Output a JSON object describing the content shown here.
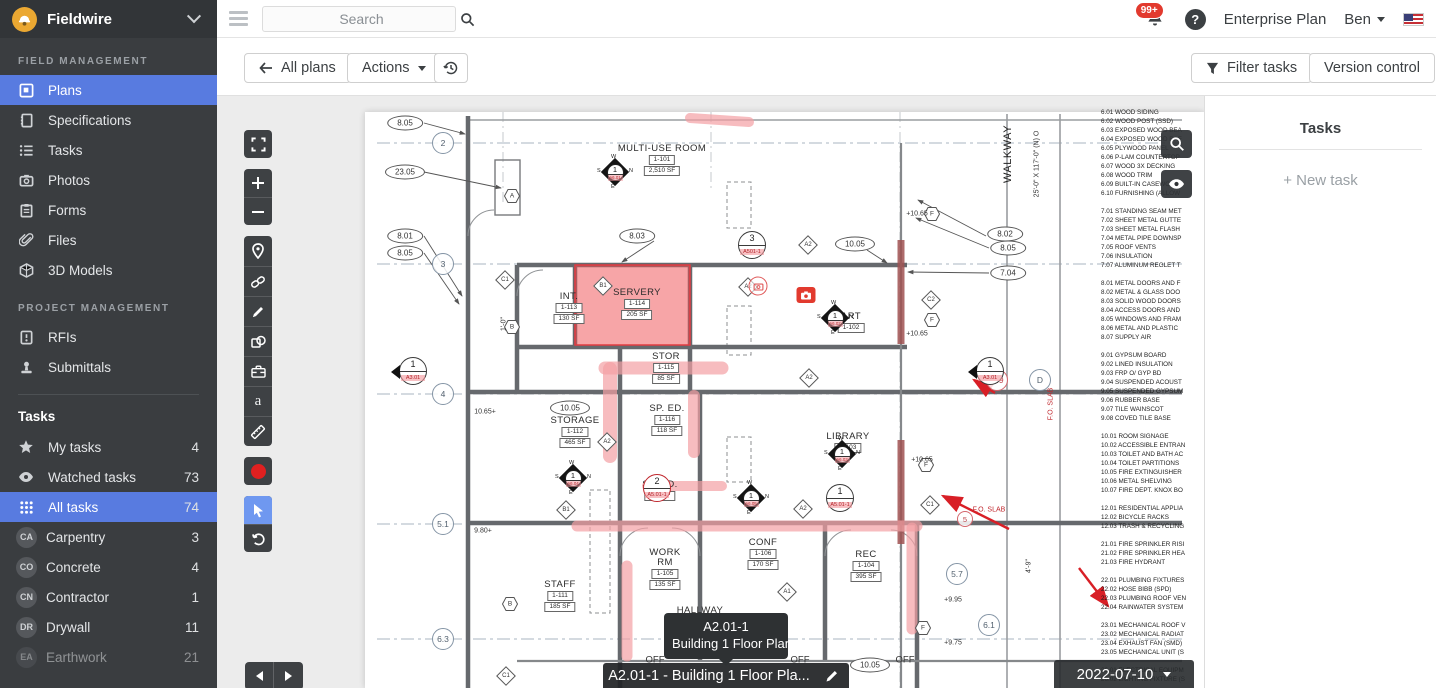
{
  "brand": {
    "name": "Fieldwire"
  },
  "topbar": {
    "search_placeholder": "Search",
    "notif_badge": "99+",
    "help_label": "?",
    "plan_label": "Enterprise Plan",
    "user_name": "Ben"
  },
  "toolbar": {
    "all_plans": "All plans",
    "actions": "Actions",
    "filter_tasks": "Filter tasks",
    "version_control": "Version control"
  },
  "sidebar": {
    "field_mgmt_label": "FIELD MANAGEMENT",
    "project_mgmt_label": "PROJECT MANAGEMENT",
    "tasks_label": "Tasks",
    "field_items": [
      {
        "label": "Plans",
        "icon": "plans-icon",
        "active": true
      },
      {
        "label": "Specifications",
        "icon": "specifications-icon"
      },
      {
        "label": "Tasks",
        "icon": "tasks-icon"
      },
      {
        "label": "Photos",
        "icon": "photos-icon"
      },
      {
        "label": "Forms",
        "icon": "forms-icon"
      },
      {
        "label": "Files",
        "icon": "files-icon"
      },
      {
        "label": "3D Models",
        "icon": "3d-models-icon"
      }
    ],
    "project_items": [
      {
        "label": "RFIs",
        "icon": "rfis-icon"
      },
      {
        "label": "Submittals",
        "icon": "submittals-icon"
      }
    ],
    "task_items": [
      {
        "label": "My tasks",
        "count": "4",
        "icon": "star-icon"
      },
      {
        "label": "Watched tasks",
        "count": "73",
        "icon": "eye-icon"
      },
      {
        "label": "All tasks",
        "count": "74",
        "icon": "grid-icon",
        "active": true
      },
      {
        "label": "Carpentry",
        "count": "3",
        "badge": "CA"
      },
      {
        "label": "Concrete",
        "count": "4",
        "badge": "CO"
      },
      {
        "label": "Contractor",
        "count": "1",
        "badge": "CN"
      },
      {
        "label": "Drywall",
        "count": "11",
        "badge": "DR"
      },
      {
        "label": "Earthwork",
        "count": "21",
        "badge": "EA"
      }
    ]
  },
  "tasks_panel": {
    "title": "Tasks",
    "new_task": "+ New task"
  },
  "plan": {
    "title_bar": "A2.01-1 - Building 1 Floor Pla...",
    "tooltip_line1": "A2.01-1",
    "tooltip_line2": "Building 1 Floor Plan",
    "version_date": "2022-07-10",
    "rooms": [
      {
        "x": 445,
        "y": 48,
        "name": "MULTI-USE ROOM",
        "num": "1-101",
        "area": "2,510 SF"
      },
      {
        "x": 352,
        "y": 196,
        "name": "INT.",
        "num": "1-113",
        "area": "130 SF"
      },
      {
        "x": 420,
        "y": 192,
        "name": "SERVERY",
        "num": "1-114",
        "area": "205 SF"
      },
      {
        "x": 449,
        "y": 256,
        "name": "STOR",
        "num": "1-115",
        "area": "85 SF"
      },
      {
        "x": 634,
        "y": 216,
        "name": "ART",
        "num": "1-102",
        "area": ""
      },
      {
        "x": 358,
        "y": 320,
        "name": "STORAGE",
        "num": "1-112",
        "area": "465 SF"
      },
      {
        "x": 450,
        "y": 308,
        "name": "SP. ED.",
        "num": "1-116",
        "area": "118 SF"
      },
      {
        "x": 443,
        "y": 384,
        "name": "SP. ED.",
        "num": "",
        "area": "118 SF"
      },
      {
        "x": 631,
        "y": 336,
        "name": "LIBRARY",
        "num": "1-103",
        "area": ""
      },
      {
        "x": 448,
        "y": 452,
        "name": "WORK\nRM",
        "num": "1-105",
        "area": "135 SF"
      },
      {
        "x": 546,
        "y": 442,
        "name": "CONF",
        "num": "1-106",
        "area": "170 SF"
      },
      {
        "x": 649,
        "y": 454,
        "name": "REC",
        "num": "1-104",
        "area": "395 SF"
      },
      {
        "x": 343,
        "y": 484,
        "name": "STAFF",
        "num": "1-111",
        "area": "185 SF"
      },
      {
        "x": 483,
        "y": 510,
        "name": "HALLWAY",
        "num": "",
        "area": ""
      }
    ],
    "ellipse_callouts": [
      {
        "x": 188,
        "y": 27,
        "label": "8.05"
      },
      {
        "x": 188,
        "y": 76,
        "label": "23.05"
      },
      {
        "x": 188,
        "y": 140,
        "label": "8.01"
      },
      {
        "x": 188,
        "y": 157,
        "label": "8.05"
      },
      {
        "x": 420,
        "y": 140,
        "label": "8.03"
      },
      {
        "x": 638,
        "y": 148,
        "label": "10.05"
      },
      {
        "x": 788,
        "y": 138,
        "label": "8.02"
      },
      {
        "x": 791,
        "y": 152,
        "label": "8.05"
      },
      {
        "x": 791,
        "y": 177,
        "label": "7.04"
      },
      {
        "x": 353,
        "y": 312,
        "label": "10.05"
      },
      {
        "x": 653,
        "y": 569,
        "label": "10.05"
      }
    ],
    "grid_circles": [
      {
        "x": 226,
        "y": 47,
        "label": "2"
      },
      {
        "x": 226,
        "y": 168,
        "label": "3"
      },
      {
        "x": 226,
        "y": 298,
        "label": "4"
      },
      {
        "x": 226,
        "y": 428,
        "label": "5.1"
      },
      {
        "x": 226,
        "y": 543,
        "label": "6.3"
      },
      {
        "x": 740,
        "y": 478,
        "label": "5.7"
      },
      {
        "x": 772,
        "y": 529,
        "label": "6.1"
      },
      {
        "x": 780,
        "y": 284,
        "label": "C.9",
        "cls": "red"
      },
      {
        "x": 823,
        "y": 284,
        "label": "D"
      },
      {
        "x": 748,
        "y": 423,
        "label": "5",
        "cls": "red sm"
      }
    ],
    "hex_markers": [
      {
        "x": 295,
        "y": 100,
        "label": "A"
      },
      {
        "x": 295,
        "y": 231,
        "label": "B"
      },
      {
        "x": 293,
        "y": 508,
        "label": "B"
      },
      {
        "x": 715,
        "y": 118,
        "label": "F"
      },
      {
        "x": 715,
        "y": 224,
        "label": "F"
      },
      {
        "x": 709,
        "y": 369,
        "label": "F"
      },
      {
        "x": 706,
        "y": 532,
        "label": "F"
      }
    ],
    "diamond_markers": [
      {
        "x": 288,
        "y": 184,
        "label": "C1"
      },
      {
        "x": 713,
        "y": 409,
        "label": "C1"
      },
      {
        "x": 289,
        "y": 580,
        "label": "C1"
      },
      {
        "x": 714,
        "y": 204,
        "label": "C2"
      },
      {
        "x": 591,
        "y": 149,
        "label": "A2"
      },
      {
        "x": 531,
        "y": 191,
        "label": "A2"
      },
      {
        "x": 592,
        "y": 282,
        "label": "A2"
      },
      {
        "x": 390,
        "y": 346,
        "label": "A2"
      },
      {
        "x": 586,
        "y": 413,
        "label": "A2"
      },
      {
        "x": 386,
        "y": 190,
        "label": "B1"
      },
      {
        "x": 349,
        "y": 414,
        "label": "B1"
      },
      {
        "x": 570,
        "y": 496,
        "label": "A1"
      }
    ],
    "section_circles": [
      {
        "x": 535,
        "y": 149,
        "num": "3",
        "ref": "A501-1"
      },
      {
        "x": 196,
        "y": 275,
        "num": "1",
        "ref": "A3.01",
        "cls": "tri"
      },
      {
        "x": 773,
        "y": 275,
        "num": "1",
        "ref": "A3.01",
        "cls": "tri"
      },
      {
        "x": 623,
        "y": 402,
        "num": "1",
        "ref": "A5.01-1"
      },
      {
        "x": 440,
        "y": 392,
        "num": "2",
        "ref": "A5.01-1",
        "cls": "ring"
      }
    ],
    "compass_markers": [
      {
        "x": 398,
        "y": 76,
        "num": "1",
        "ref": "A6.01",
        "w": "W",
        "n": "N",
        "e": "E",
        "s": "S"
      },
      {
        "x": 618,
        "y": 222,
        "num": "1",
        "ref": "A6.02",
        "w": "W",
        "n": "N",
        "e": "E",
        "s": "S"
      },
      {
        "x": 356,
        "y": 382,
        "num": "1",
        "ref": "A6.04",
        "w": "W",
        "n": "N",
        "e": "E",
        "s": "S"
      },
      {
        "x": 534,
        "y": 402,
        "num": "1",
        "ref": "A6.05",
        "w": "W",
        "n": "N",
        "e": "E",
        "s": "S"
      },
      {
        "x": 625,
        "y": 358,
        "num": "1",
        "ref": "A6.03",
        "w": "W",
        "n": "N",
        "e": "E",
        "s": "S"
      }
    ],
    "texts": [
      {
        "x": 700,
        "y": 118,
        "label": "+10.65"
      },
      {
        "x": 700,
        "y": 238,
        "label": "+10.65"
      },
      {
        "x": 705,
        "y": 364,
        "label": "+10.65"
      },
      {
        "x": 268,
        "y": 316,
        "label": "10.65+"
      },
      {
        "x": 266,
        "y": 435,
        "label": "9.80+"
      },
      {
        "x": 736,
        "y": 504,
        "label": "+9.95"
      },
      {
        "x": 736,
        "y": 547,
        "label": "+9.75"
      },
      {
        "x": 287,
        "y": 228,
        "label": "1'-0\"",
        "cls": "rot"
      },
      {
        "x": 812,
        "y": 470,
        "label": "4'-9\"",
        "cls": "rot"
      },
      {
        "x": 772,
        "y": 414,
        "label": "F.O. SLAB",
        "cls": "red"
      },
      {
        "x": 834,
        "y": 308,
        "label": "F.O. SLAB",
        "cls": "red rot"
      },
      {
        "x": 791,
        "y": 58,
        "label": "WALKWAY",
        "cls": "rot big"
      },
      {
        "x": 820,
        "y": 68,
        "label": "25'-0\" X 117'-0\" (N) O",
        "cls": "rot tiny"
      },
      {
        "x": 438,
        "y": 564,
        "label": "OFF",
        "cls": "off"
      },
      {
        "x": 583,
        "y": 564,
        "label": "OFF",
        "cls": "off"
      },
      {
        "x": 688,
        "y": 564,
        "label": "OFF",
        "cls": "off"
      }
    ],
    "notes": [
      "6.01   WOOD SIDING",
      "6.02   WOOD POST (SSD)",
      "6.03   EXPOSED WOOD BEA",
      "6.04   EXPOSED WOOD RAF",
      "6.05   PLYWOOD PANEL",
      "6.06   P-LAM COUNTERTOP",
      "6.07   WOOD 3X DECKING",
      "6.08   WOOD TRIM",
      "6.09   BUILT-IN CASEWORK",
      "6.10   FURNISHING (ALLOW",
      "",
      "7.01   STANDING SEAM MET",
      "7.02   SHEET METAL GUTTE",
      "7.03   SHEET METAL FLASH",
      "7.04   METAL PIPE DOWNSP",
      "7.05   ROOF VENTS",
      "7.06   INSULATION",
      "7.07   ALUMINUM REGLET T",
      "",
      "8.01   METAL DOORS AND F",
      "8.02   METAL & GLASS DOO",
      "8.03   SOLID WOOD DOORS",
      "8.04   ACCESS DOORS AND",
      "8.05   WINDOWS AND FRAM",
      "8.06   METAL AND PLASTIC",
      "8.07   SUPPLY AIR",
      "",
      "9.01   GYPSUM BOARD",
      "9.02   LINED INSULATION",
      "9.03   FRP O/ GYP BD",
      "9.04   SUSPENDED ACOUST",
      "9.05   SUSPENDED GYPSUM",
      "9.06   RUBBER BASE",
      "9.07   TILE WAINSCOT",
      "9.08   COVED TILE BASE",
      "",
      "10.01  ROOM SIGNAGE",
      "10.02  ACCESSIBLE ENTRAN",
      "10.03  TOILET AND BATH AC",
      "10.04  TOILET PARTITIONS",
      "10.05  FIRE EXTINGUISHER",
      "10.06  METAL SHELVING",
      "10.07  FIRE DEPT. KNOX BO",
      "",
      "12.01  RESIDENTIAL APPLIA",
      "12.02  BICYCLE RACKS",
      "12.03  TRASH & RECYCLING",
      "",
      "21.01  FIRE SPRINKLER RISI",
      "21.02  FIRE SPRINKLER HEA",
      "21.03  FIRE HYDRANT",
      "",
      "22.01  PLUMBING FIXTURES",
      "22.02  HOSE BIBB (SPD)",
      "22.03  PLUMBING ROOF VEN",
      "22.04  RAINWATER SYSTEM",
      "",
      "23.01  MECHANICAL ROOF V",
      "23.02  MECHANICAL RADIAT",
      "23.04  EXHAUST FAN (SMD)",
      "23.05  MECHANICAL UNIT (S",
      "",
      "26.01  ELECTRICAL EQUIPM",
      "26.02  LIGHTING FIXTURE (S"
    ]
  }
}
